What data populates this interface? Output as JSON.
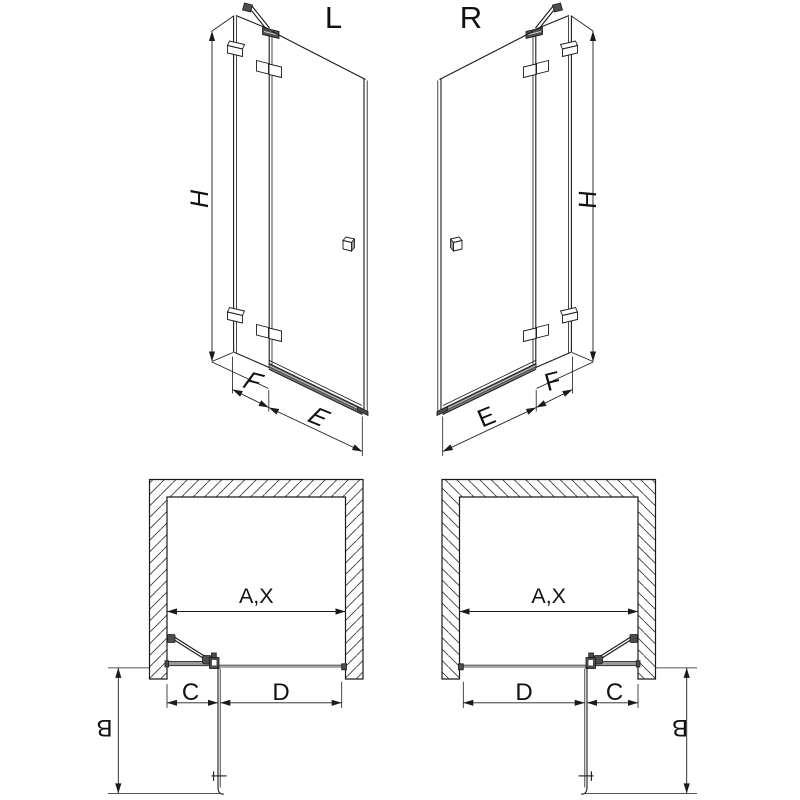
{
  "diagram": {
    "title_hint": "shower door technical drawing, left and right hand versions",
    "views": {
      "left_3d": {
        "label": "L",
        "dim_height": "H",
        "dim_fixed_panel": "F",
        "dim_door": "E"
      },
      "right_3d": {
        "label": "R",
        "dim_height": "H",
        "dim_fixed_panel": "F",
        "dim_door": "E"
      },
      "left_plan": {
        "dim_opening": "A,X",
        "dim_fixed_segment": "C",
        "dim_door_segment": "D",
        "dim_swing_depth": "B"
      },
      "right_plan": {
        "dim_opening": "A,X",
        "dim_fixed_segment": "C",
        "dim_door_segment": "D",
        "dim_swing_depth": "B"
      }
    },
    "colors": {
      "line": "#1a1a1a",
      "metal_dark": "#4d4d4d",
      "metal_mid": "#9a9a9a",
      "background": "#ffffff"
    },
    "icons": []
  }
}
